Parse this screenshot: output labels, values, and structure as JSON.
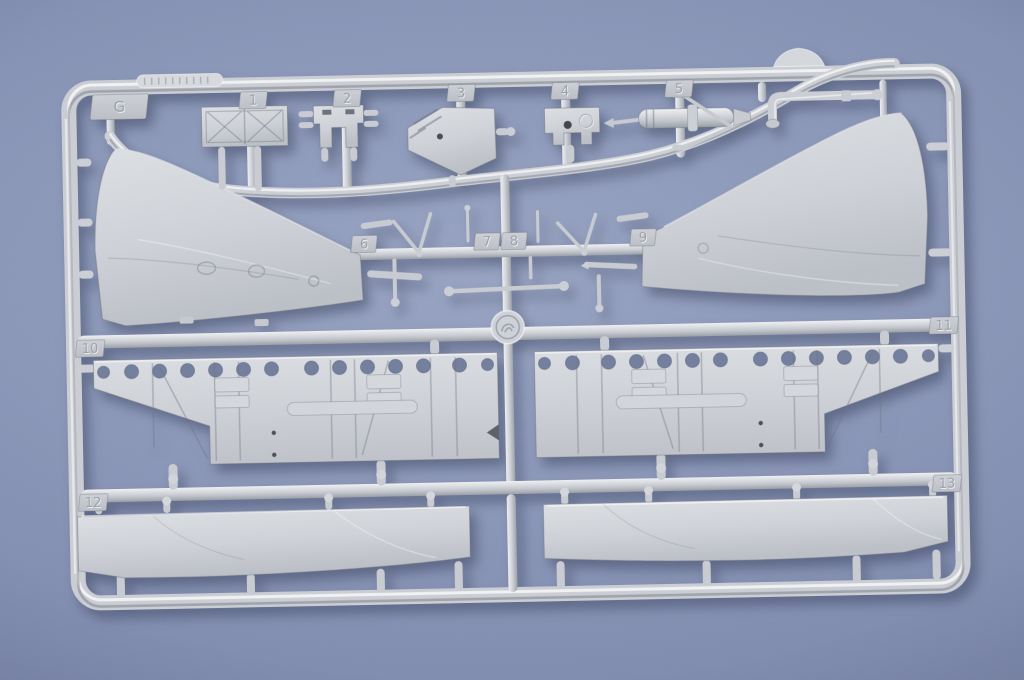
{
  "image": {
    "subject": "Injection-molded plastic model kit sprue (runner G) photographed on a blue-gray backdrop"
  },
  "colors": {
    "background": "#8a96b8",
    "backdrop_edge": "#6e799b",
    "plastic_base": "#ced1d7",
    "plastic_highlight": "#eff1f3",
    "plastic_shadow": "#9aa0a8"
  },
  "sprue": {
    "runner_letter": "G",
    "tabs": [
      {
        "label": "G"
      },
      {
        "label": "1"
      },
      {
        "label": "2"
      },
      {
        "label": "3"
      },
      {
        "label": "4"
      },
      {
        "label": "5"
      },
      {
        "label": "6"
      },
      {
        "label": "7"
      },
      {
        "label": "8"
      },
      {
        "label": "9"
      },
      {
        "label": "10"
      },
      {
        "label": "11"
      },
      {
        "label": "12"
      },
      {
        "label": "13"
      }
    ],
    "parts": [
      "braced truss panel",
      "mounting bracket",
      "angled plate",
      "castellated box",
      "cylinder with A-frame",
      "left curved fairing panel",
      "right curved fairing panel",
      "strut and rod set",
      "left bulkhead with lightening holes",
      "right bulkhead with lightening holes",
      "left long hull strip",
      "right long hull strip",
      "elbow pipe",
      "small dome"
    ]
  }
}
